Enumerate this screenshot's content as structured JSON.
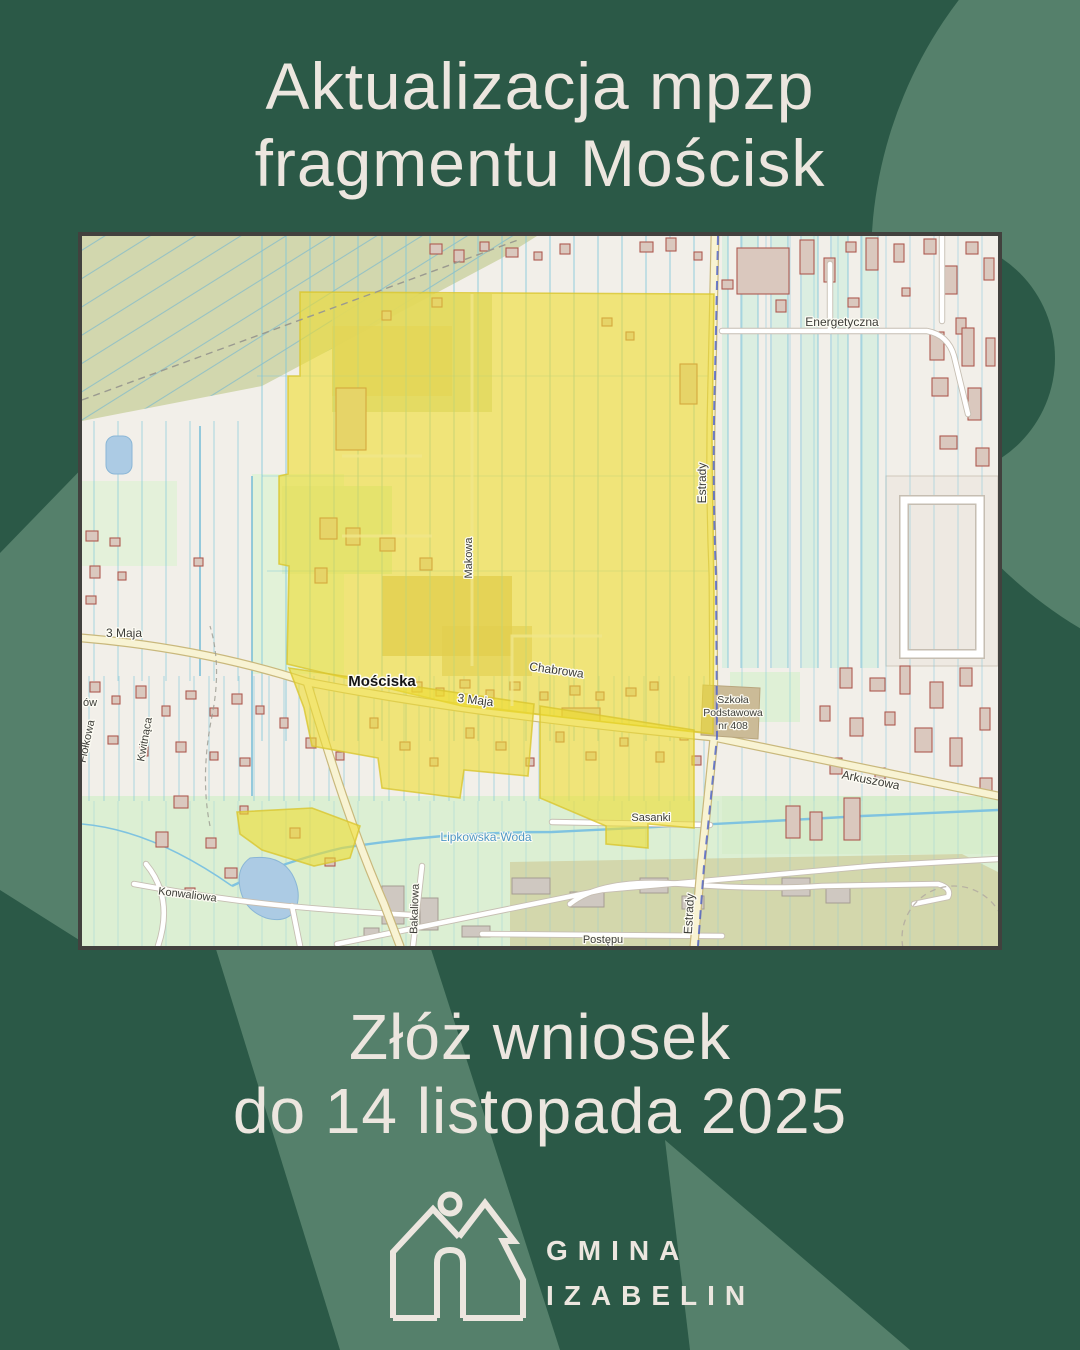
{
  "poster": {
    "title_line1": "Aktualizacja mpzp",
    "title_line2": "fragmentu Mościsk",
    "cta_line1": "Złóż wniosek",
    "cta_line2": "do 14 listopada 2025"
  },
  "logo": {
    "org_line1": "GMINA",
    "org_line2": "IZABELIN",
    "icon": "house-tree-sun-icon"
  },
  "colors": {
    "background_dark": "#2b5947",
    "background_light": "#55806b",
    "text_cream": "#ece6df",
    "map_base": "#f2efe9",
    "map_highlight_yellow": "#eedc2e",
    "map_water": "#accbe4",
    "map_building_red": "#ae5a50",
    "map_road_principal": "#f8f3d3",
    "map_boundary_blue": "#4a5fc8"
  },
  "map": {
    "description": "plan area highlight over Mościska",
    "labels": {
      "moscisk_place": "Mościska",
      "maja3": "3 Maja",
      "chabrowa": "Chabrowa",
      "makowa": "Makowa",
      "estrady": "Estrady",
      "energetyczna": "Energetyczna",
      "arkuszowa": "Arkuszowa",
      "sasanki": "Sasanki",
      "konwaliowa": "Konwaliowa",
      "bakaliowa": "Bakaliowa",
      "postepu": "Postępu",
      "kwitnaca": "Kwitnąca",
      "fiolkowa": "Fiołkowa",
      "fragment_ow": "ów",
      "lipkowska": "Lipkowska-Woda",
      "szkola_line1": "Szkoła",
      "szkola_line2": "Podstawowa",
      "szkola_line3": "nr 408"
    }
  }
}
